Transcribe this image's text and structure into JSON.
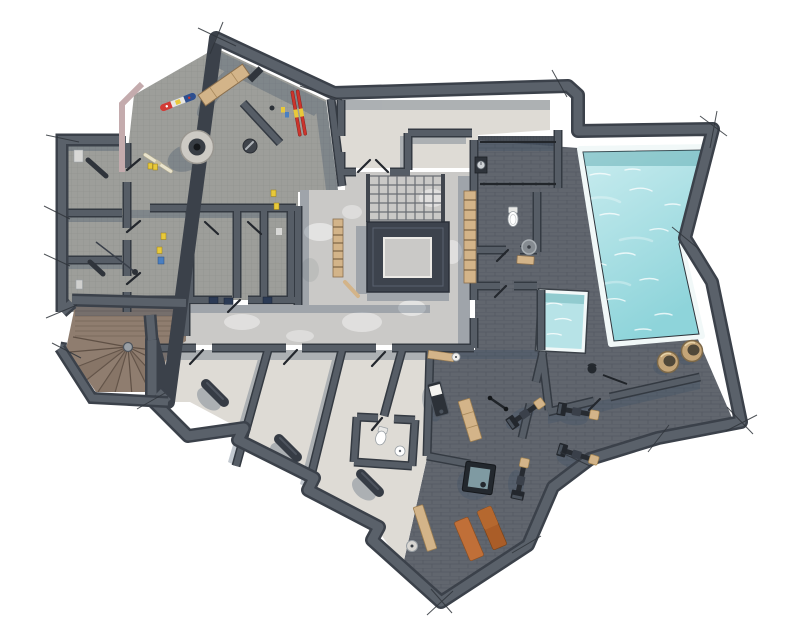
{
  "scene": {
    "type": "architectural-floor-plan",
    "style": "top-down 3d rendered basement / spa level plan with sketch edge lines",
    "background": "#ffffff"
  },
  "colors": {
    "wall": "#5a616a",
    "wall_edge": "#3b414a",
    "ski_floor": "#9d9e9a",
    "concrete": "#cac9c7",
    "room_light": "#dedbd5",
    "brick": "#61666e",
    "grate": "#494f58",
    "pool_water_light": "#c9ecef",
    "pool_water": "#8ed4da",
    "pool_rim": "#f1f8f8",
    "plunge_water": "#b7e3e7",
    "wood_floor": "#8f7d6f",
    "wood_dark": "#5f5045",
    "bench_wood": "#d3b489",
    "mat_orange": "#c06f38",
    "mat_orange_dark": "#aa5d28",
    "stool_wicker": "#c4a578",
    "pink_band": "#c4abad",
    "shadow": "#3d5068",
    "equipment": "#272b31",
    "towel": "#f4f3f0",
    "ski_red": "#cc342c",
    "board_blue": "#2e4f8f",
    "board_red": "#d23b35",
    "board_mid": "#e8e6e2",
    "accent_yellow": "#e8c93a",
    "cream": "#e9e3cc",
    "porcelain": "#ffffff",
    "steel": "#9aa0a6"
  },
  "features": [
    {
      "id": "ski-room",
      "kind": "room"
    },
    {
      "id": "boot-dryer",
      "kind": "equipment"
    },
    {
      "id": "snowboard",
      "kind": "gear"
    },
    {
      "id": "red-skis",
      "kind": "gear"
    },
    {
      "id": "cream-ski",
      "kind": "gear"
    },
    {
      "id": "ski-bench",
      "kind": "furniture"
    },
    {
      "id": "storage-rooms",
      "kind": "room",
      "count": 3
    },
    {
      "id": "ski-lockers",
      "kind": "room",
      "count": 4
    },
    {
      "id": "spiral-staircase",
      "kind": "stair"
    },
    {
      "id": "central-staircase",
      "kind": "stair"
    },
    {
      "id": "stair-void",
      "kind": "opening"
    },
    {
      "id": "corridor",
      "kind": "circulation"
    },
    {
      "id": "swimming-pool",
      "kind": "water"
    },
    {
      "id": "plunge-pool",
      "kind": "water"
    },
    {
      "id": "wicker-stools",
      "kind": "furniture",
      "count": 2
    },
    {
      "id": "spa-wc",
      "kind": "room"
    },
    {
      "id": "massage-table",
      "kind": "furniture"
    },
    {
      "id": "treatment-rooms",
      "kind": "room",
      "count": 4
    },
    {
      "id": "treatment-bolsters",
      "kind": "furniture",
      "count": 3
    },
    {
      "id": "gym",
      "kind": "room"
    },
    {
      "id": "gym-machines",
      "kind": "equipment",
      "count": 4
    },
    {
      "id": "yoga-mats",
      "kind": "equipment",
      "count": 2
    },
    {
      "id": "ice-bath",
      "kind": "water"
    },
    {
      "id": "wc",
      "kind": "room"
    },
    {
      "id": "wood-benches",
      "kind": "furniture",
      "count": 3
    }
  ]
}
